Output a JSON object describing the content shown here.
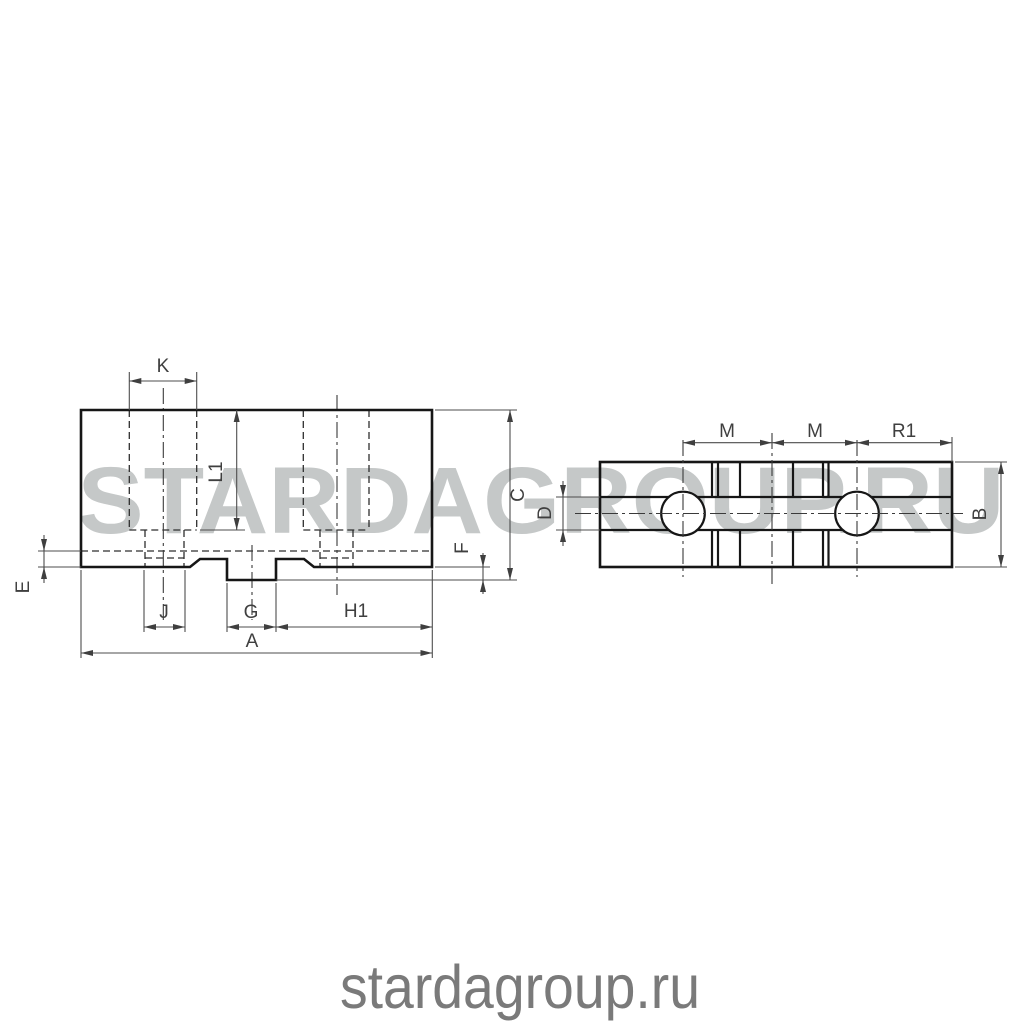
{
  "watermarks": {
    "large": "STARDAGROUP.RU",
    "small": "stardagroup.ru"
  },
  "colors": {
    "background": "#ffffff",
    "object_line": "#161616",
    "dimension_line": "#4d4d4d",
    "label_text": "#3f3f3f",
    "watermark_large": "#c5c8c8",
    "watermark_small": "#7a7a7a"
  },
  "front_view": {
    "description": "front view of chuck jaw with stepped bottom tongue and two hidden counterbored holes",
    "labels": {
      "k": "K",
      "l1": "L1",
      "c": "C",
      "e": "E",
      "f": "F",
      "j": "J",
      "g": "G",
      "h1": "H1",
      "a": "A"
    }
  },
  "top_view": {
    "description": "top view of chuck jaw with two holes, central slot and serration lines",
    "labels": {
      "m1": "M",
      "m2": "M",
      "r1": "R1",
      "d": "D",
      "b": "B"
    }
  }
}
